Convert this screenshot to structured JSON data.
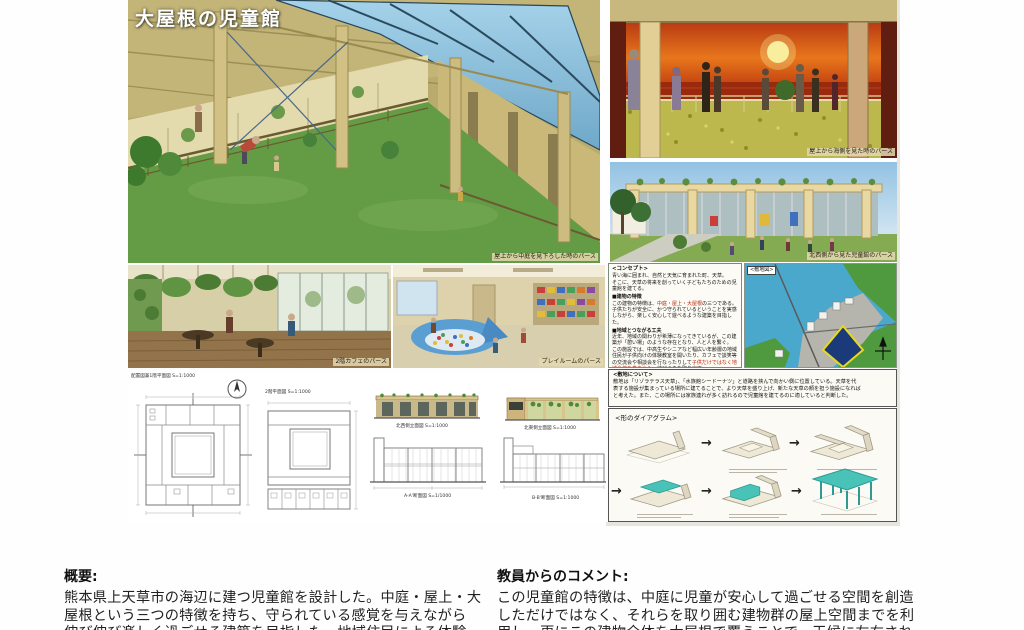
{
  "poster": {
    "title": "大屋根の児童館",
    "captions": {
      "main": "屋上から中庭を見下ろした時のパース",
      "sunset": "屋上から海側を見た時のパース",
      "exterior": "北西側から見た児童館のパース",
      "cafe": "2階カフェのパース",
      "playroom": "プレイルームのパース"
    },
    "concept": {
      "heading": "<コンセプト>",
      "intro1": "青い海に囲まれ、自然と天気に育まれた町、天草。",
      "intro2": "そこに、天草の将来を創っていく子どもたちのための児童館を建てる。",
      "feature_heading": "■建物の特徴",
      "feature1_pre": "この建物の特徴は、",
      "feature1_red": "中庭・屋上・大屋根",
      "feature1_post": "の三つである。",
      "feature2": "子供たちが安全に、かつ守られているということを実感しながら、楽しく安心して遊べるような建築を目指した。",
      "community_heading": "■地域とつながる工夫",
      "community1": "近年、地域の関わりが希薄になってきているが、この建築が「憩い場」のような存在となり、人と人を繋ぐ。",
      "community2_pre": "この施設では、中高生やシニアなど幅広い年齢層の地域住民が子供向けの体験教室を開いたり、カフェで談笑等の交流会や相談会を行なったりして",
      "community2_red": "子供だけではなく地域全体を巻き込み",
      "community2_post": "、結びつきを取り戻す。"
    },
    "site_map_heading": "<敷地図>",
    "site_about": {
      "heading": "<敷地について>",
      "line1": "敷地は「リゾラテラス天草」、「水族館シードーナツ」と道路を挟んで向かい側に位置している。天草を代",
      "line2": "表する施設が集まっている場所に建てることで、より天草を盛り上げ、新たな天草の顔を担う施設になれば",
      "line3": "と考えた。また、この場所には家族連れが多く訪れるので児童館を建てるのに適していると判断した。"
    },
    "drawings": {
      "site_plan_label": "配置図兼1階平面図 S=1:1000",
      "plan2_label": "2階平面図 S=1:1000",
      "elev_nw_label": "北西側立面図 S=1:1000",
      "elev_ne_label": "北東側立面図 S=1:1000",
      "section_a_label": "A-A'断面図 S=1/1000",
      "section_b_label": "B-B'断面図 S=1:1000"
    },
    "form_diagram": {
      "heading": "<形のダイアグラム>",
      "arrow": "→"
    }
  },
  "footer": {
    "overview": {
      "heading": "概要:",
      "line1": "熊本県上天草市の海辺に建つ児童館を設計した。中庭・屋上・大",
      "line2": "屋根という三つの特徴を持ち、守られている感覚を与えながら",
      "line3": "伸び伸び楽しく過ごせる建築を目指した。地域住民による体験"
    },
    "comment": {
      "heading": "教員からのコメント:",
      "line1": "この児童館の特徴は、中庭に児童が安心して過ごせる空間を創造",
      "line2": "しただけではなく、それらを取り囲む建物群の屋上空間までを利",
      "line3": "用し、更にこの建物全体を大屋根で覆うことで、天候に左右され"
    }
  },
  "colors": {
    "accent_red": "#cc2200",
    "diagram_teal": "#49c2b8",
    "grass_green": "#649c46",
    "sky_blue": "#8cc0de",
    "sunset_orange": "#d85a16",
    "ocean_blue": "#4aa8cc",
    "wood_tan": "#cdbc80"
  }
}
